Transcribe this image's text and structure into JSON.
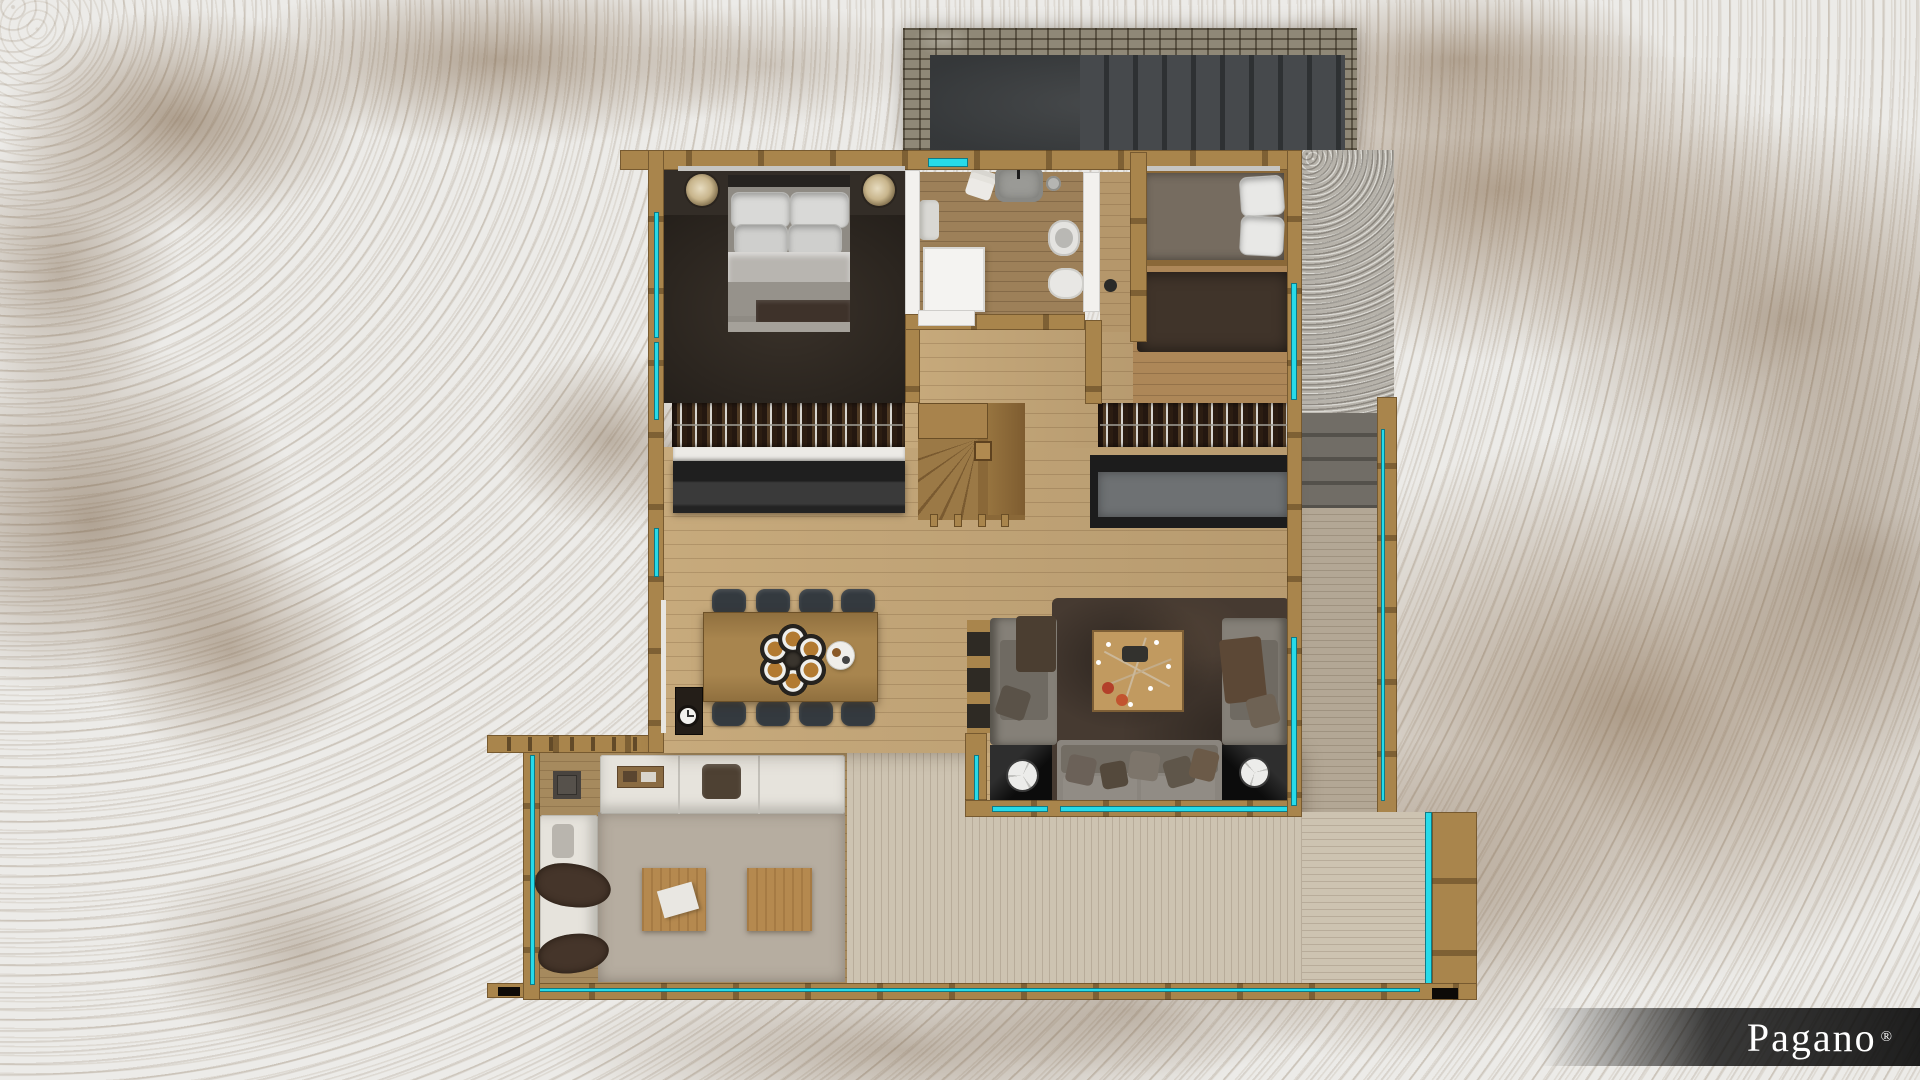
{
  "watermark": {
    "brand": "Pagano",
    "registered": "®"
  },
  "palette": {
    "glass_accent": "#27dbe9",
    "wood_frame": "#a9854c",
    "snow": "#ecebe8",
    "dirt": "#7a5f42",
    "court_concrete": "#3c3f41",
    "stone_wall": "#8f8877",
    "bedroom_dark_floor": "#3a322a",
    "interior_floor": "#c7aa7c",
    "deck_pale": "#cdc3b1",
    "living_rug": "#463a31",
    "veranda_rug": "#b6ada0",
    "sofa_gray": "#8a857e",
    "outdoor_sofa_white": "#e6e3dc",
    "kitchen_counter": "#222222"
  },
  "scene": {
    "type": "rendered floor plan, top view, chalet in snow",
    "rooms": [
      {
        "name": "entrance-court",
        "items": [
          "stone-wall",
          "concrete-platform",
          "exterior-steps"
        ]
      },
      {
        "name": "master-bedroom",
        "items": [
          "double-bed",
          "pillows",
          "bedside-lamp-left",
          "bedside-lamp-right",
          "wardrobe"
        ]
      },
      {
        "name": "bathroom",
        "items": [
          "shower",
          "washbasin",
          "towels",
          "toilet",
          "bidet",
          "skylight"
        ]
      },
      {
        "name": "second-bedroom",
        "items": [
          "single-bed",
          "pillows",
          "rug",
          "wardrobe"
        ]
      },
      {
        "name": "kitchen-dining",
        "items": [
          "kitchen-counter",
          "dining-table",
          "eight-chairs",
          "place-settings",
          "serving-tray",
          "clock"
        ]
      },
      {
        "name": "living-room",
        "items": [
          "three-sofas",
          "coffee-table-with-branch-decor",
          "shag-rug",
          "two-corner-tables",
          "interior-stair"
        ]
      },
      {
        "name": "veranda-winter-garden",
        "items": [
          "white-corner-sofa",
          "fur-throws",
          "two-square-coffee-tables",
          "rug",
          "side-table"
        ]
      },
      {
        "name": "south-deck",
        "items": [
          "two-lounge-chairs",
          "cube-table",
          "glass-balustrade"
        ]
      },
      {
        "name": "east-walkway",
        "items": [
          "exterior-steps",
          "gravel",
          "glass-balustrade"
        ]
      }
    ],
    "counts": {
      "dining_chairs": 8,
      "place_settings": 6,
      "lounge_chairs": 2,
      "outdoor_coffee_tables": 2
    }
  }
}
